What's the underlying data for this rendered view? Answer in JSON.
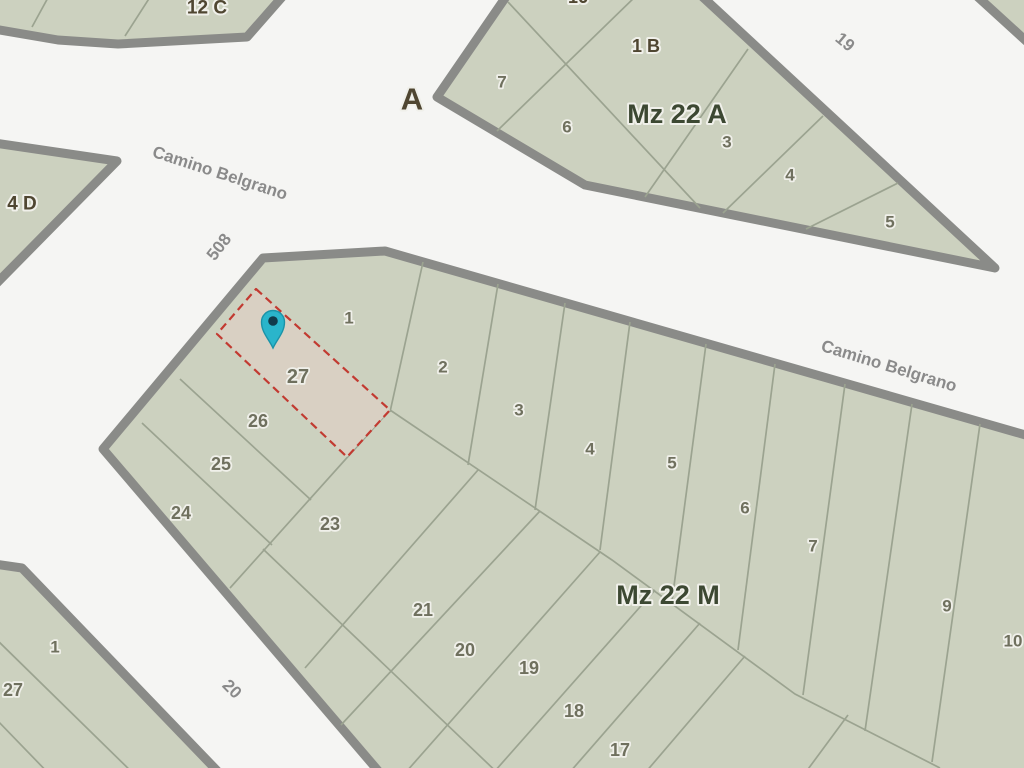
{
  "map": {
    "colors": {
      "background": "#f5f5f3",
      "block_fill": "#ccd1bf",
      "block_border": "#8a8b88",
      "parcel_line": "#9ba390",
      "highlight_fill": "#d9d0c3",
      "highlight_stroke": "#c23a31",
      "pin_fill": "#2ab5cb",
      "pin_stroke": "#1b93a8",
      "pin_dot": "#113b4b",
      "parcel_text": "#6f705e",
      "block_text": "#3c4832",
      "street_text": "#8a8a8a",
      "area_text": "#4f4631",
      "halo": "#f0f0ea"
    },
    "blocks": [
      {
        "id": "block-12c",
        "points": [
          [
            -12,
            -12
          ],
          [
            290,
            -12
          ],
          [
            247,
            37
          ],
          [
            118,
            44
          ],
          [
            58,
            40
          ],
          [
            -12,
            28
          ]
        ]
      },
      {
        "id": "block-top-right",
        "points": [
          [
            968,
            -12
          ],
          [
            1036,
            -12
          ],
          [
            1036,
            50
          ]
        ]
      },
      {
        "id": "block-4d",
        "points": [
          [
            -12,
            142
          ],
          [
            117,
            161
          ],
          [
            -12,
            292
          ]
        ]
      },
      {
        "id": "block-mz22a",
        "points": [
          [
            437,
            97
          ],
          [
            512,
            -12
          ],
          [
            693,
            -12
          ],
          [
            995,
            268
          ],
          [
            585,
            185
          ]
        ]
      },
      {
        "id": "block-mz22m",
        "points": [
          [
            263,
            258
          ],
          [
            385,
            251
          ],
          [
            1036,
            438
          ],
          [
            1036,
            780
          ],
          [
            386,
            780
          ],
          [
            103,
            449
          ]
        ]
      },
      {
        "id": "block-bottom-left",
        "points": [
          [
            -12,
            563
          ],
          [
            22,
            568
          ],
          [
            226,
            780
          ],
          [
            -12,
            780
          ]
        ]
      }
    ],
    "parcel_lines": [
      [
        152,
        -6,
        125,
        36
      ],
      [
        50,
        -6,
        32,
        27
      ],
      [
        638,
        -6,
        497,
        131
      ],
      [
        508,
        2,
        700,
        208
      ],
      [
        748,
        49,
        645,
        197
      ],
      [
        823,
        116,
        723,
        213
      ],
      [
        898,
        183,
        806,
        229
      ],
      [
        423,
        262,
        390,
        412
      ],
      [
        498,
        284,
        468,
        465
      ],
      [
        565,
        303,
        535,
        510
      ],
      [
        630,
        322,
        600,
        550
      ],
      [
        706,
        344,
        672,
        601
      ],
      [
        775,
        364,
        738,
        650
      ],
      [
        845,
        384,
        803,
        695
      ],
      [
        912,
        404,
        865,
        731
      ],
      [
        980,
        424,
        932,
        762
      ],
      [
        390,
        410,
        612,
        560,
        795,
        694,
        940,
        768
      ],
      [
        180,
        379,
        311,
        500
      ],
      [
        142,
        423,
        272,
        545
      ],
      [
        388,
        412,
        230,
        588
      ],
      [
        263,
        549,
        505,
        780
      ],
      [
        478,
        470,
        305,
        668
      ],
      [
        540,
        511,
        341,
        725
      ],
      [
        600,
        552,
        399,
        780
      ],
      [
        655,
        590,
        487,
        780
      ],
      [
        700,
        623,
        563,
        780
      ],
      [
        745,
        656,
        639,
        780
      ],
      [
        848,
        715,
        800,
        780
      ],
      [
        -6,
        637,
        140,
        780
      ],
      [
        -6,
        717,
        55,
        780
      ]
    ],
    "highlighted_parcel": {
      "label": "27",
      "points": [
        [
          256,
          289
        ],
        [
          390,
          410
        ],
        [
          347,
          457
        ],
        [
          217,
          334
        ]
      ]
    },
    "pin": {
      "x": 273,
      "y": 322
    },
    "labels": {
      "street": [
        {
          "text": "Camino Belgrano",
          "x": 220,
          "y": 173,
          "rot": 18,
          "size": 17
        },
        {
          "text": "Camino Belgrano",
          "x": 889,
          "y": 366,
          "rot": 17,
          "size": 17
        },
        {
          "text": "508",
          "x": 219,
          "y": 247,
          "rot": -52,
          "size": 17
        },
        {
          "text": "19",
          "x": 845,
          "y": 42,
          "rot": 40,
          "size": 17
        },
        {
          "text": "20",
          "x": 232,
          "y": 689,
          "rot": 45,
          "size": 17
        }
      ],
      "block": [
        {
          "text": "Mz 22 A",
          "x": 677,
          "y": 114,
          "size": 27
        },
        {
          "text": "Mz 22 M",
          "x": 668,
          "y": 595,
          "size": 27
        }
      ],
      "area": [
        {
          "text": "A",
          "x": 412,
          "y": 99,
          "size": 31
        },
        {
          "text": "12 C",
          "x": 207,
          "y": 8,
          "size": 19
        },
        {
          "text": "4 D",
          "x": 22,
          "y": 204,
          "size": 19
        },
        {
          "text": "1 B",
          "x": 646,
          "y": 46,
          "size": 18
        },
        {
          "text": "16",
          "x": 578,
          "y": -3,
          "size": 18
        }
      ],
      "parcel": [
        {
          "text": "7",
          "x": 502,
          "y": 82,
          "size": 17
        },
        {
          "text": "6",
          "x": 567,
          "y": 127,
          "size": 17
        },
        {
          "text": "3",
          "x": 727,
          "y": 142,
          "size": 17
        },
        {
          "text": "4",
          "x": 790,
          "y": 175,
          "size": 17
        },
        {
          "text": "5",
          "x": 890,
          "y": 222,
          "size": 17
        },
        {
          "text": "1",
          "x": 349,
          "y": 318,
          "size": 17
        },
        {
          "text": "2",
          "x": 443,
          "y": 367,
          "size": 17
        },
        {
          "text": "3",
          "x": 519,
          "y": 410,
          "size": 17
        },
        {
          "text": "4",
          "x": 590,
          "y": 449,
          "size": 17
        },
        {
          "text": "5",
          "x": 672,
          "y": 463,
          "size": 17
        },
        {
          "text": "6",
          "x": 745,
          "y": 508,
          "size": 17
        },
        {
          "text": "7",
          "x": 813,
          "y": 546,
          "size": 17
        },
        {
          "text": "9",
          "x": 947,
          "y": 606,
          "size": 17
        },
        {
          "text": "10",
          "x": 1013,
          "y": 641,
          "size": 17
        },
        {
          "text": "27",
          "x": 298,
          "y": 377,
          "size": 20
        },
        {
          "text": "26",
          "x": 258,
          "y": 421,
          "size": 18
        },
        {
          "text": "25",
          "x": 221,
          "y": 464,
          "size": 18
        },
        {
          "text": "24",
          "x": 181,
          "y": 513,
          "size": 18
        },
        {
          "text": "23",
          "x": 330,
          "y": 524,
          "size": 18
        },
        {
          "text": "21",
          "x": 423,
          "y": 610,
          "size": 18
        },
        {
          "text": "20",
          "x": 465,
          "y": 650,
          "size": 18
        },
        {
          "text": "19",
          "x": 529,
          "y": 668,
          "size": 18
        },
        {
          "text": "18",
          "x": 574,
          "y": 711,
          "size": 18
        },
        {
          "text": "17",
          "x": 620,
          "y": 750,
          "size": 18
        },
        {
          "text": "1",
          "x": 55,
          "y": 647,
          "size": 17
        },
        {
          "text": "27",
          "x": 13,
          "y": 690,
          "size": 18
        }
      ]
    }
  }
}
